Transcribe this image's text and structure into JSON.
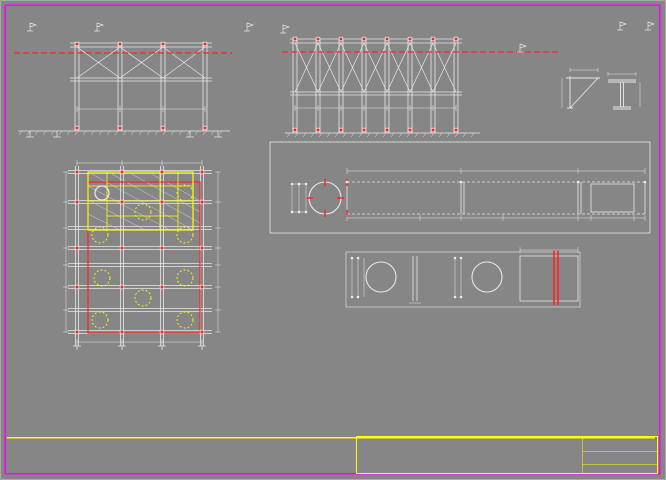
{
  "colors": {
    "bg": "#868686",
    "frame": "#ff00ff",
    "green": "#00ff00",
    "yellow": "#ffff00",
    "red": "#ff2222",
    "white": "#eeeeee"
  },
  "annotations": [
    {
      "n": "main-title",
      "t": "CẤU TẠO HỆ SÀN ĐẠO",
      "x": 214,
      "y": 6,
      "fs": 9,
      "b": 1,
      "u": 1
    },
    {
      "n": "title-elev-left",
      "t": "MẶT CẮT 1-1",
      "x": 110,
      "y": 11,
      "fs": 7,
      "b": 1
    },
    {
      "n": "title-elev-right",
      "t": "MẶT CẮT 2-2",
      "x": 366,
      "y": 11,
      "fs": 7,
      "b": 1
    },
    {
      "n": "label-mntc-left",
      "t": "MNTC (+4,55)",
      "x": 6,
      "y": 39,
      "fs": 4.2
    },
    {
      "n": "level-mark",
      "t": "+4,50",
      "x": 50,
      "y": 25,
      "fs": 4.2
    },
    {
      "n": "callout-label",
      "t": "2I400\n(L=10000)",
      "x": 53,
      "y": 33,
      "fs": 4.2
    },
    {
      "n": "callout-label",
      "t": "L75x75x6\nL=7500",
      "x": 40,
      "y": 66,
      "fs": 4.2
    },
    {
      "n": "callout-label",
      "t": "L75x75x6\n(L=14000)",
      "x": 39,
      "y": 90,
      "fs": 4.2
    },
    {
      "n": "callout-label",
      "t": "2I400\n(L=10000)",
      "x": 161,
      "y": 15,
      "fs": 4.2
    },
    {
      "n": "label-cu-larsen",
      "t": "Cừ Larsen A",
      "x": 208,
      "y": 46,
      "fs": 4.2
    },
    {
      "n": "dim-label",
      "t": "(650)",
      "x": 92,
      "y": 103,
      "fs": 4.2
    },
    {
      "n": "dim-label",
      "t": "4500",
      "x": 135,
      "y": 103,
      "fs": 4.2
    },
    {
      "n": "dim-label",
      "t": "4500",
      "x": 178,
      "y": 103,
      "fs": 4.2
    },
    {
      "n": "level-mark",
      "t": "+0,50",
      "x": 38,
      "y": 126,
      "fs": 4.2
    },
    {
      "n": "level-mark",
      "t": "+4,50",
      "x": 252,
      "y": 25,
      "fs": 4.2
    },
    {
      "n": "label-cu-larsen",
      "t": "Cừ Larsen A",
      "x": 463,
      "y": 47,
      "fs": 4.2
    },
    {
      "n": "label-mntc-right",
      "t": "MNTC (+4,55)",
      "x": 497,
      "y": 38,
      "fs": 4.2
    },
    {
      "n": "dim-label",
      "t": "1250",
      "x": 300,
      "y": 104,
      "fs": 3.8
    },
    {
      "n": "dim-label",
      "t": "1250",
      "x": 323,
      "y": 104,
      "fs": 3.8
    },
    {
      "n": "dim-label",
      "t": "1250",
      "x": 346,
      "y": 104,
      "fs": 3.8
    },
    {
      "n": "dim-label",
      "t": "2450",
      "x": 368,
      "y": 104,
      "fs": 3.8
    },
    {
      "n": "dim-label",
      "t": "2450",
      "x": 391,
      "y": 104,
      "fs": 3.8
    },
    {
      "n": "dim-label",
      "t": "2450",
      "x": 414,
      "y": 104,
      "fs": 3.8
    },
    {
      "n": "dim-label",
      "t": "2400",
      "x": 437,
      "y": 104,
      "fs": 3.8
    },
    {
      "n": "callout-label",
      "t": "L75x75x6\nL=4500",
      "x": 470,
      "y": 11,
      "fs": 4.2
    },
    {
      "n": "callout-label",
      "t": "L75x75x6\nL=2400",
      "x": 470,
      "y": 53,
      "fs": 4.2
    },
    {
      "n": "callout-label",
      "t": "L75x75x6\nL=6000",
      "x": 470,
      "y": 73,
      "fs": 4.2
    },
    {
      "n": "callout-label",
      "t": "L75x75x6\nL=3000",
      "x": 470,
      "y": 93,
      "fs": 4.2
    },
    {
      "n": "callout-label",
      "t": "2I400\nL=10000",
      "x": 470,
      "y": 114,
      "fs": 4.2
    },
    {
      "n": "callout-label",
      "t": "2I400\nL=12000",
      "x": 214,
      "y": 112,
      "fs": 4.2
    },
    {
      "n": "title-detail-a",
      "t": "CHI TIẾT A",
      "x": 584,
      "y": 40,
      "fs": 5.5,
      "b": 1,
      "u": 1
    },
    {
      "n": "detail-a-subtitle",
      "t": "(tấm thép dày 12mm)",
      "x": 566,
      "y": 49,
      "fs": 4
    },
    {
      "n": "dim-label",
      "t": "600",
      "x": 578,
      "y": 63,
      "fs": 4
    },
    {
      "n": "dim-label",
      "t": "450",
      "x": 560,
      "y": 98,
      "fs": 4,
      "r": 1
    },
    {
      "n": "dim-label",
      "t": "600",
      "x": 615,
      "y": 67,
      "fs": 4
    },
    {
      "n": "dim-label",
      "t": "25",
      "x": 639,
      "y": 76,
      "fs": 4
    },
    {
      "n": "dim-label",
      "t": "12",
      "x": 637,
      "y": 92,
      "fs": 4
    },
    {
      "n": "dim-label",
      "t": "240",
      "x": 616,
      "y": 110,
      "fs": 4
    },
    {
      "n": "level-mark",
      "t": "+4,50",
      "x": 612,
      "y": 19,
      "fs": 4
    },
    {
      "n": "title-strip-plan",
      "t": "MẶT BẰNG BỐ TRÍ CỌC ĐỊNH VỊ VÀ HỆ DẦM SÀN ĐẠO THI CÔNG",
      "x": 390,
      "y": 149,
      "fs": 6,
      "b": 1,
      "u": 1
    },
    {
      "n": "strip-subtitle",
      "t": "(2 bộ)",
      "x": 476,
      "y": 159,
      "fs": 4.2
    },
    {
      "n": "callout-label",
      "t": "Cọc định vị\nI400",
      "x": 243,
      "y": 150,
      "fs": 4
    },
    {
      "n": "dim-label",
      "t": "4600",
      "x": 412,
      "y": 164,
      "fs": 4.2
    },
    {
      "n": "dim-label",
      "t": "6450",
      "x": 512,
      "y": 164,
      "fs": 4.2
    },
    {
      "n": "dim-label",
      "t": "3500",
      "x": 608,
      "y": 164,
      "fs": 4.2
    },
    {
      "n": "dim-label",
      "t": "1060",
      "x": 287,
      "y": 206,
      "fs": 3.8,
      "r": 1
    },
    {
      "n": "dim-label",
      "t": "800",
      "x": 294,
      "y": 204,
      "fs": 3.8,
      "r": 1
    },
    {
      "n": "dim-label",
      "t": "1060",
      "x": 301,
      "y": 206,
      "fs": 3.8,
      "r": 1
    },
    {
      "n": "dim-label",
      "t": "1140",
      "x": 578,
      "y": 205,
      "fs": 3.8,
      "r": 1
    },
    {
      "n": "dim-label",
      "t": "800",
      "x": 598,
      "y": 203,
      "fs": 3.8,
      "r": 1
    },
    {
      "n": "dim-label",
      "t": "1060",
      "x": 640,
      "y": 205,
      "fs": 3.8,
      "r": 1
    },
    {
      "n": "dim-label",
      "t": "4200",
      "x": 395,
      "y": 216,
      "fs": 4.2
    },
    {
      "n": "dim-label",
      "t": "1460",
      "x": 500,
      "y": 216,
      "fs": 4.2
    },
    {
      "n": "dim-label",
      "t": "2750",
      "x": 588,
      "y": 216,
      "fs": 4.2
    },
    {
      "n": "dim-label",
      "t": "150",
      "x": 630,
      "y": 216,
      "fs": 4.2
    },
    {
      "n": "segment-label",
      "t": "ĐN SỐ 02",
      "x": 356,
      "y": 225,
      "fs": 3.8
    },
    {
      "n": "segment-label",
      "t": "CH SỐ 01",
      "x": 423,
      "y": 225,
      "fs": 3.8
    },
    {
      "n": "segment-label",
      "t": "NỐI ĐN 01",
      "x": 468,
      "y": 225,
      "fs": 3.8
    },
    {
      "n": "segment-label",
      "t": "NỐI ĐN 02",
      "x": 526,
      "y": 225,
      "fs": 3.8
    },
    {
      "n": "segment-label",
      "t": "CH SỐ 02",
      "x": 584,
      "y": 225,
      "fs": 3.8
    },
    {
      "n": "title-section-3",
      "t": "MẶT CẮT 3-3",
      "x": 369,
      "y": 237,
      "fs": 6.5,
      "b": 1
    },
    {
      "n": "title-section-4",
      "t": "MẶT CẮT 4-4",
      "x": 516,
      "y": 237,
      "fs": 6.5,
      "b": 1
    },
    {
      "n": "dim-label",
      "t": "200",
      "x": 406,
      "y": 301,
      "fs": 4
    },
    {
      "n": "dim-label",
      "t": "1500",
      "x": 538,
      "y": 244,
      "fs": 4
    },
    {
      "n": "dim-label",
      "t": "1450",
      "x": 348,
      "y": 288,
      "fs": 3.8,
      "r": 1
    },
    {
      "n": "dim-label",
      "t": "1400",
      "x": 355,
      "y": 286,
      "fs": 3.8,
      "r": 1
    },
    {
      "n": "dim-label",
      "t": "1450",
      "x": 452,
      "y": 288,
      "fs": 3.8,
      "r": 1
    },
    {
      "n": "dim-label",
      "t": "1400",
      "x": 459,
      "y": 286,
      "fs": 3.8,
      "r": 1
    },
    {
      "n": "dim-label",
      "t": "800",
      "x": 522,
      "y": 284,
      "fs": 3.8,
      "r": 1
    },
    {
      "n": "title-plan",
      "t": "MẶT BẰNG SÀN ĐẠO",
      "x": 106,
      "y": 146,
      "fs": 6.5,
      "b": 1
    },
    {
      "n": "plan-note",
      "t": "Thép bản phục vụ thi công\n1500x2000x10mm",
      "x": 214,
      "y": 150,
      "fs": 4
    },
    {
      "n": "dim-label",
      "t": "4500",
      "x": 92,
      "y": 156,
      "fs": 4.2
    },
    {
      "n": "dim-label",
      "t": "4500",
      "x": 134,
      "y": 156,
      "fs": 4.2
    },
    {
      "n": "dim-label",
      "t": "4500",
      "x": 176,
      "y": 156,
      "fs": 4.2
    },
    {
      "n": "dim-label",
      "t": "700",
      "x": 58,
      "y": 191,
      "fs": 3.8,
      "r": 1
    },
    {
      "n": "dim-label",
      "t": "1950",
      "x": 58,
      "y": 220,
      "fs": 3.8,
      "r": 1
    },
    {
      "n": "dim-label",
      "t": "1280",
      "x": 58,
      "y": 245,
      "fs": 3.8,
      "r": 1
    },
    {
      "n": "dim-label",
      "t": "2850",
      "x": 58,
      "y": 265,
      "fs": 3.8,
      "r": 1
    },
    {
      "n": "dim-label",
      "t": "2850",
      "x": 58,
      "y": 285,
      "fs": 3.8,
      "r": 1
    },
    {
      "n": "dim-label",
      "t": "2970",
      "x": 58,
      "y": 307,
      "fs": 3.8,
      "r": 1
    },
    {
      "n": "dim-label",
      "t": "3000",
      "x": 58,
      "y": 330,
      "fs": 3.8,
      "r": 1
    },
    {
      "n": "dim-label",
      "t": "1060",
      "x": 219,
      "y": 196,
      "fs": 3.8,
      "r": 1
    },
    {
      "n": "dim-label",
      "t": "1950",
      "x": 219,
      "y": 223,
      "fs": 3.8,
      "r": 1
    },
    {
      "n": "dim-label",
      "t": "2850",
      "x": 219,
      "y": 248,
      "fs": 3.8,
      "r": 1
    },
    {
      "n": "dim-label",
      "t": "2850",
      "x": 219,
      "y": 268,
      "fs": 3.8,
      "r": 1
    },
    {
      "n": "dim-label",
      "t": "2970",
      "x": 219,
      "y": 288,
      "fs": 3.8,
      "r": 1
    },
    {
      "n": "dim-label",
      "t": "3000",
      "x": 219,
      "y": 310,
      "fs": 3.8,
      "r": 1
    },
    {
      "n": "dim-label",
      "t": "4500",
      "x": 90,
      "y": 346,
      "fs": 4.2
    },
    {
      "n": "dim-label",
      "t": "4500",
      "x": 132,
      "y": 346,
      "fs": 4.2
    },
    {
      "n": "dim-label",
      "t": "4500",
      "x": 174,
      "y": 346,
      "fs": 4.2
    },
    {
      "n": "callout-label",
      "t": "2I400\n(L=10000)",
      "x": 24,
      "y": 246,
      "fs": 4.2
    },
    {
      "n": "callout-label",
      "t": "2I400\n(L=12000)",
      "x": 233,
      "y": 291,
      "fs": 4.2
    },
    {
      "n": "callout-label",
      "t": "2I400\n(L=9000)",
      "x": 72,
      "y": 360,
      "fs": 4.2
    },
    {
      "n": "callout-label",
      "t": "2I400\n(L=10200)",
      "x": 133,
      "y": 357,
      "fs": 4.2
    },
    {
      "n": "notes-title",
      "t": "GHI CHÚ:",
      "x": 25,
      "y": 381,
      "fs": 5,
      "u": 1
    },
    {
      "n": "note-line",
      "t": "- Kích thước bản vẽ ghi theo mm, cao độ ghi theo m.",
      "x": 10,
      "y": 392,
      "fs": 4.6
    },
    {
      "n": "note-line",
      "t": "- Thép bản giằng và thi công chốt để đảm bảo luân chuyển cho từng cọc.",
      "x": 10,
      "y": 403,
      "fs": 4.6
    },
    {
      "n": "note-line",
      "t": "- Liên kết giữa các thanh trong hệ sàn đạo thi công bằng đường hàn hoặc bulon.",
      "x": 10,
      "y": 414,
      "fs": 4.6
    },
    {
      "n": "stamp-line-1",
      "t": "BIỆN PHÁP THI CÔNG CỌC KHOAN NHỒI",
      "x": 128,
      "y": 442,
      "fs": 5,
      "b": 1
    },
    {
      "n": "stamp-line-2",
      "t": "XUÂN 2017",
      "x": 161,
      "y": 457,
      "fs": 5,
      "b": 1
    },
    {
      "n": "title-summary-table",
      "t": "BẢNG TỔNG HỢP KHỐI LƯỢNG",
      "x": 516,
      "y": 295,
      "fs": 6,
      "b": 1,
      "u": 1
    }
  ],
  "balloons": [
    {
      "x": 46,
      "y": 43,
      "n": "1"
    },
    {
      "x": 33,
      "y": 74,
      "n": "2"
    },
    {
      "x": 32,
      "y": 98,
      "n": "2"
    },
    {
      "x": 154,
      "y": 25,
      "n": "1"
    },
    {
      "x": 506,
      "y": 18,
      "n": "4"
    },
    {
      "x": 504,
      "y": 60,
      "n": "5"
    },
    {
      "x": 504,
      "y": 80,
      "n": "6"
    },
    {
      "x": 504,
      "y": 100,
      "n": "7"
    },
    {
      "x": 504,
      "y": 122,
      "n": "8"
    },
    {
      "x": 243,
      "y": 120,
      "n": "8"
    },
    {
      "x": 277,
      "y": 161,
      "n": "3"
    },
    {
      "x": 16,
      "y": 254,
      "n": "8"
    },
    {
      "x": 262,
      "y": 302,
      "n": "8"
    },
    {
      "x": 64,
      "y": 367,
      "n": "9"
    },
    {
      "x": 176,
      "y": 365,
      "n": "10"
    }
  ],
  "bom_materials": {
    "title": "THỐNG KÊ VẬT TƯ THÉP HÌNH CHO KẾT CẤU SÀN ĐẠO PHỤC VỤ THI CÔNG",
    "headers": [
      "STT",
      "Ký hiệu",
      "Quy cách",
      "Đơn vị",
      "Chiều dài (m)",
      "Số lượng",
      "Đơn trọng (kg)",
      "Khối lượng (kg)",
      "Ghi chú"
    ],
    "rows": [
      [
        "1",
        "D1",
        "I400",
        "Thanh",
        "10,00",
        "12",
        "722,0",
        "8.664,0",
        "Cọc định vị"
      ],
      [
        "2",
        "D2",
        "I400",
        "Thanh",
        "12,00",
        "4",
        "866,4",
        "3.465,6",
        "Nối cọc định vị bằng hàn"
      ],
      [
        "3",
        "D3",
        "I400",
        "Thanh",
        "4,50",
        "7",
        "325,0",
        "2.275,0",
        "Nối cọc định vị bằng hàn"
      ],
      [
        "4",
        "G1",
        "L75x75x6",
        "Thanh",
        "7,50",
        "12",
        "51,5",
        "618,0",
        "Hệ giằng liên kết"
      ],
      [
        "5",
        "G2",
        "L75x75x6",
        "Thanh",
        "4,50",
        "46",
        "30,9",
        "1.421,4",
        "Hệ giằng liên kết"
      ],
      [
        "6",
        "G3",
        "L75x75x6",
        "Thanh",
        "2,40",
        "13",
        "16,5",
        "214,5",
        "Hệ giằng liên kết"
      ],
      [
        "7",
        "G4",
        "L75x75x6",
        "Thanh",
        "6,00",
        "7",
        "41,2",
        "288,4",
        "Hệ giằng liên kết"
      ],
      [
        "8",
        "G5",
        "L75x75x6",
        "Thanh",
        "3,00",
        "4",
        "20,6",
        "82,4",
        "Hệ giằng liên kết"
      ],
      [
        "9",
        "G6",
        "L75x75x6",
        "Thanh",
        "14,00",
        "16",
        "96,1",
        "1.537,6",
        "Hệ giằng liên kết"
      ],
      [
        "10",
        "T1",
        "Thép bản 10mm",
        "Tấm",
        "–",
        "16",
        "78,1",
        "1.249,6",
        "Thép bản lát sàn thao tác"
      ]
    ],
    "total_label": "Tổng khối lượng",
    "total_value": "4.676,26"
  },
  "bom_summary": {
    "headers": [
      "STT",
      "HẠNG MỤC",
      "ĐƠN VỊ",
      "SỐ LƯỢNG",
      "ĐƠN TRỌNG (KG)",
      "KHỐI LƯỢNG (KG)",
      "GHI CHÚ"
    ],
    "rows": [
      {
        "k": "sec",
        "c": [
          "I",
          "Hệ sàn đạo và sàn công tác thi công vòng vây cọc ván thép"
        ]
      },
      {
        "k": "r",
        "c": [
          "1",
          "Cọc định vị I400, L=10m",
          "Thanh",
          "20",
          "",
          "740,0 m",
          ""
        ]
      },
      {
        "k": "r",
        "c": [
          "2",
          "Thanh 2I400 D600, L=10m",
          "Thanh",
          "6",
          "1.958,6",
          "11.751,6",
          ""
        ]
      },
      {
        "k": "r",
        "c": [
          "3",
          "Thanh 2I400 D600, L=12m",
          "Thanh",
          "6",
          "1.766,0",
          "10.596,0",
          ""
        ]
      },
      {
        "k": "r",
        "c": [
          "4",
          "Thanh I400 D600, L=4,5m",
          "Thanh",
          "8",
          "330,8",
          "2.647,1",
          ""
        ]
      },
      {
        "k": "r",
        "c": [
          "5",
          "Thanh I400 D600, L=6m",
          "Cái",
          "8",
          "159,6",
          "1.276,8",
          ""
        ]
      },
      {
        "k": "r",
        "c": [
          "6",
          "Thanh I400 D600, L=7,5m",
          "Thanh",
          "1",
          "1.641,1",
          "1.641,1",
          ""
        ]
      },
      {
        "k": "r",
        "c": [
          "7",
          "Bản táp T10, L=1m",
          "Thanh",
          "16",
          "69,75",
          "617,6",
          ""
        ]
      },
      {
        "k": "sum",
        "c": [
          "",
          "Cộng",
          "",
          "",
          "",
          "25.280,8",
          ""
        ]
      },
      {
        "k": "sec",
        "c": [
          "II",
          "Thép hình phụ trợ đi kèm hệ sàn đạo"
        ]
      },
      {
        "k": "r2",
        "c": [
          "1",
          "Cẩu lắp 25T, di chuyển 1 vị trí, tháo lắp 2 lần/hệ sàn đạo, lắp 1 lần",
          "Tấn",
          "1",
          "1.751,7",
          "1.751,7",
          ""
        ]
      },
      {
        "k": "r2",
        "c": [
          "2",
          "Cẩu lắp 25T, thi công xong tháo 1 vị trí, tháo lắp 2 lần/hệ, lắp 1 lần",
          "Tấn",
          "1",
          "61,6",
          "616,7",
          ""
        ]
      },
      {
        "k": "sum",
        "c": [
          "",
          "Cộng khối lượng thép 1 hệ sàn đạo",
          "",
          "",
          "",
          "6.192,2",
          ""
        ]
      },
      {
        "k": "sum",
        "c": [
          "",
          "Tổng cộng khối lượng thép (02 hệ sàn đạo)",
          "",
          "",
          "",
          "62.024,4",
          ""
        ]
      }
    ]
  },
  "titleblock": {
    "rows": [
      [
        "Giám đốc",
        "Trần Văn Minh",
        "Chủ trì"
      ],
      [
        "Thiết kế",
        "Phan Minh Hùng",
        ""
      ],
      [
        "Kiểm tra",
        "Bùi Xuân Kiên",
        ""
      ],
      [
        "P.họa KTCL",
        "Phan Xuân Bắc",
        ""
      ]
    ],
    "company_top": "TỔNG CÔNG TY XDCTGT 4 - CTCP",
    "company": "CÔNG TY CP 482",
    "title1": "CẤU TẠO HỆ SÀN ĐẠO",
    "title2": "BIỆN PHÁP THI CÔNG CỌC KHOAN NHỒI TRỤ T2",
    "sign": "Ký hiệu b.vẽ: BPTC-02",
    "scale": "Tỉ lệ: 1/200",
    "sheet": "Bản vẽ: 04"
  }
}
